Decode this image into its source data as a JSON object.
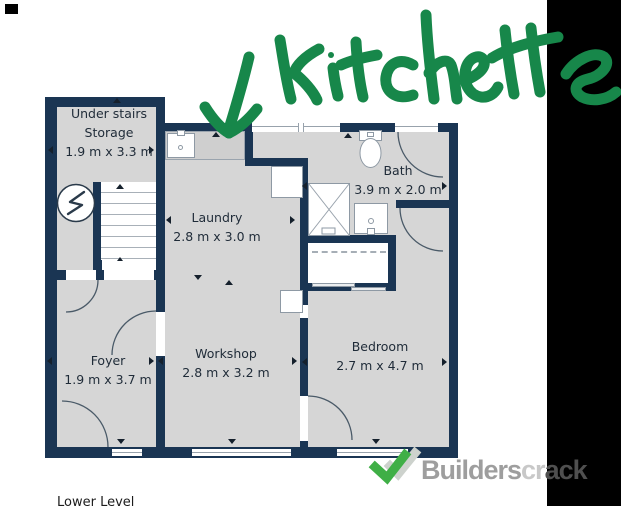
{
  "annotation": {
    "text": "kitchette",
    "color": "#17874a"
  },
  "plan": {
    "rooms": {
      "storage": {
        "line1": "Under stairs",
        "line2": "Storage",
        "dims": "1.9 m x 3.3 m"
      },
      "laundry": {
        "name": "Laundry",
        "dims": "2.8 m x 3.0 m"
      },
      "bath": {
        "name": "Bath",
        "dims": "3.9 m x 2.0 m"
      },
      "foyer": {
        "name": "Foyer",
        "dims": "1.9 m x 3.7 m"
      },
      "workshop": {
        "name": "Workshop",
        "dims": "2.8 m x 3.2 m"
      },
      "bedroom": {
        "name": "Bedroom",
        "dims": "2.7 m x 4.7 m"
      }
    },
    "level_label": "Lower Level",
    "colors": {
      "wall": "#1a3553",
      "floor": "#d6d6d6"
    }
  },
  "watermark": {
    "brand": "Builderscrack",
    "part_main": "Builders",
    "part_light": "cr",
    "part_dark": "ack",
    "icon_green": "#3faf46",
    "icon_gray": "#cdd2cd"
  }
}
